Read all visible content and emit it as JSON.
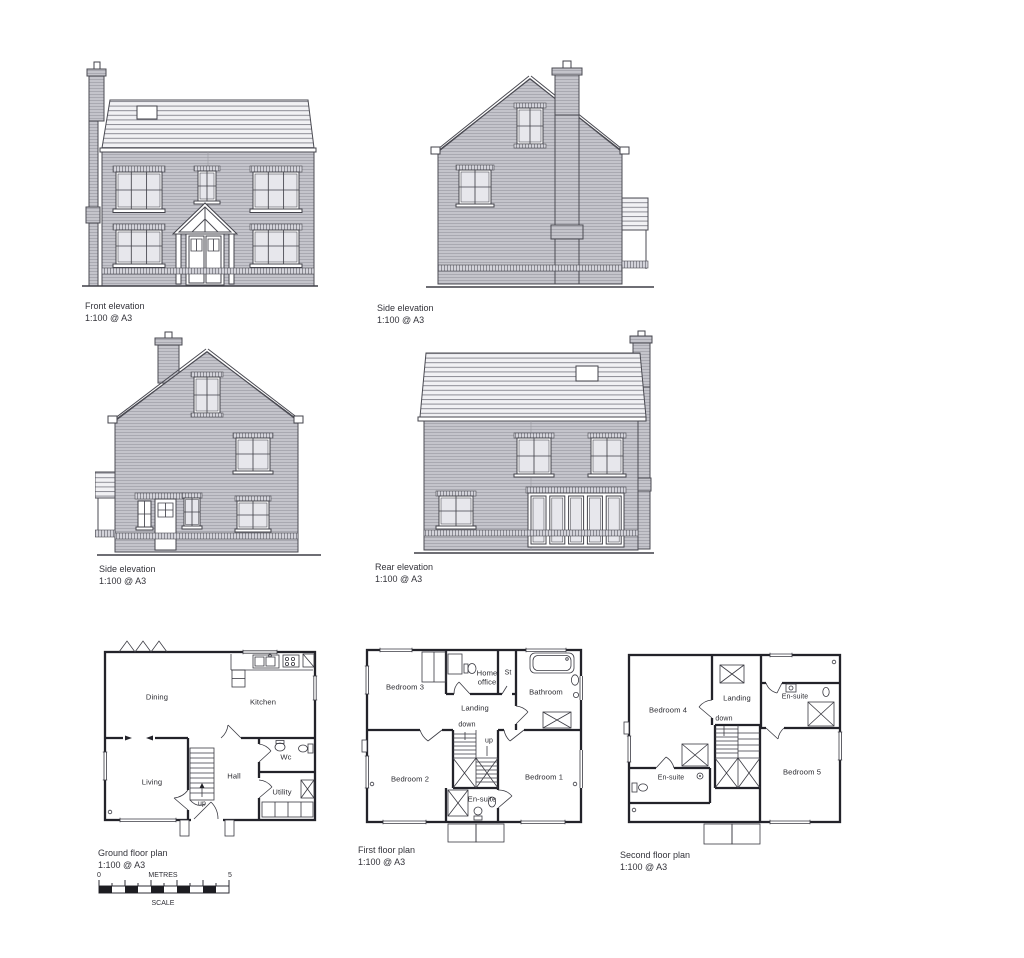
{
  "captions": {
    "front": {
      "title": "Front elevation",
      "scale": "1:100 @ A3"
    },
    "side_top": {
      "title": "Side elevation",
      "scale": "1:100 @ A3"
    },
    "side_mid": {
      "title": "Side elevation",
      "scale": "1:100 @ A3"
    },
    "rear": {
      "title": "Rear elevation",
      "scale": "1:100 @ A3"
    },
    "ground": {
      "title": "Ground floor plan",
      "scale": "1:100 @ A3"
    },
    "first": {
      "title": "First floor plan",
      "scale": "1:100 @ A3"
    },
    "second": {
      "title": "Second floor plan",
      "scale": "1:100 @ A3"
    }
  },
  "ground_rooms": {
    "dining": "Dining",
    "kitchen": "Kitchen",
    "living": "Living",
    "hall": "Hall",
    "wc": "Wc",
    "utility": "Utility",
    "stair": "up"
  },
  "first_rooms": {
    "bedroom3": "Bedroom 3",
    "home_office": "Home office",
    "store": "St",
    "bathroom": "Bathroom",
    "landing": "Landing",
    "down": "down",
    "up": "up",
    "bedroom2": "Bedroom 2",
    "bedroom1": "Bedroom 1",
    "ensuite": "En-suite"
  },
  "second_rooms": {
    "bedroom4": "Bedroom 4",
    "landing": "Landing",
    "down": "down",
    "ensuite_a": "En-suite",
    "ensuite_b": "En-suite",
    "bedroom5": "Bedroom 5"
  },
  "scale_bar": {
    "zero": "0",
    "five": "5",
    "units": "METRES",
    "caption": "SCALE"
  },
  "colors": {
    "wall_grey": "#c2c2c9",
    "roof_line": "#8d8d95",
    "line": "#4b4b53",
    "plan_line": "#23232a",
    "text": "#33333a"
  }
}
